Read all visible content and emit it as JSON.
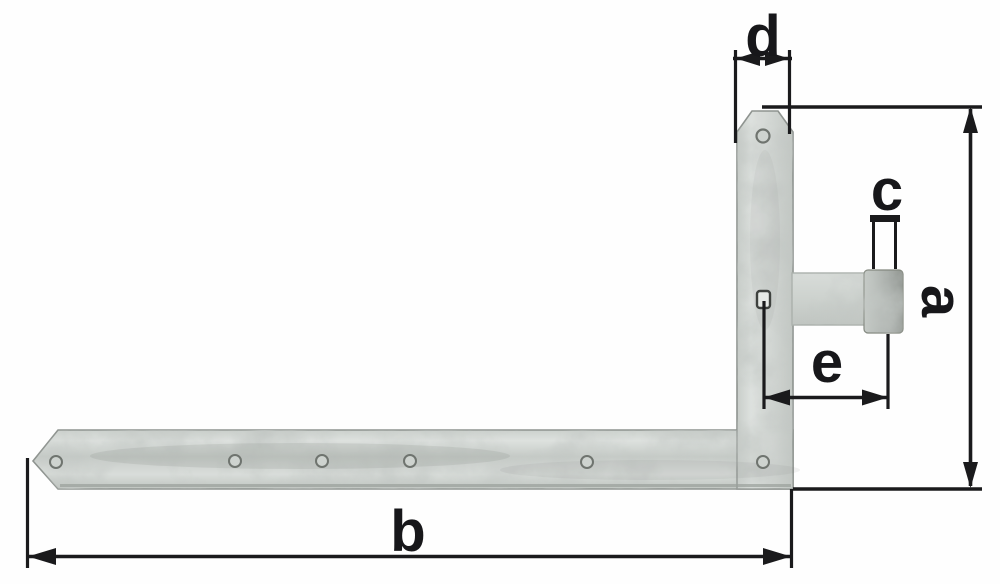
{
  "diagram": {
    "labels": {
      "a": "a",
      "b": "b",
      "c": "c",
      "d": "d",
      "e": "e"
    },
    "colors": {
      "background": "#ffffff",
      "dimension_line": "#1a1a1c",
      "steel_light": "#dde1de",
      "steel_base": "#ccd1cd",
      "steel_shadow": "#9aa09c",
      "pin": "#aab0ab"
    }
  }
}
